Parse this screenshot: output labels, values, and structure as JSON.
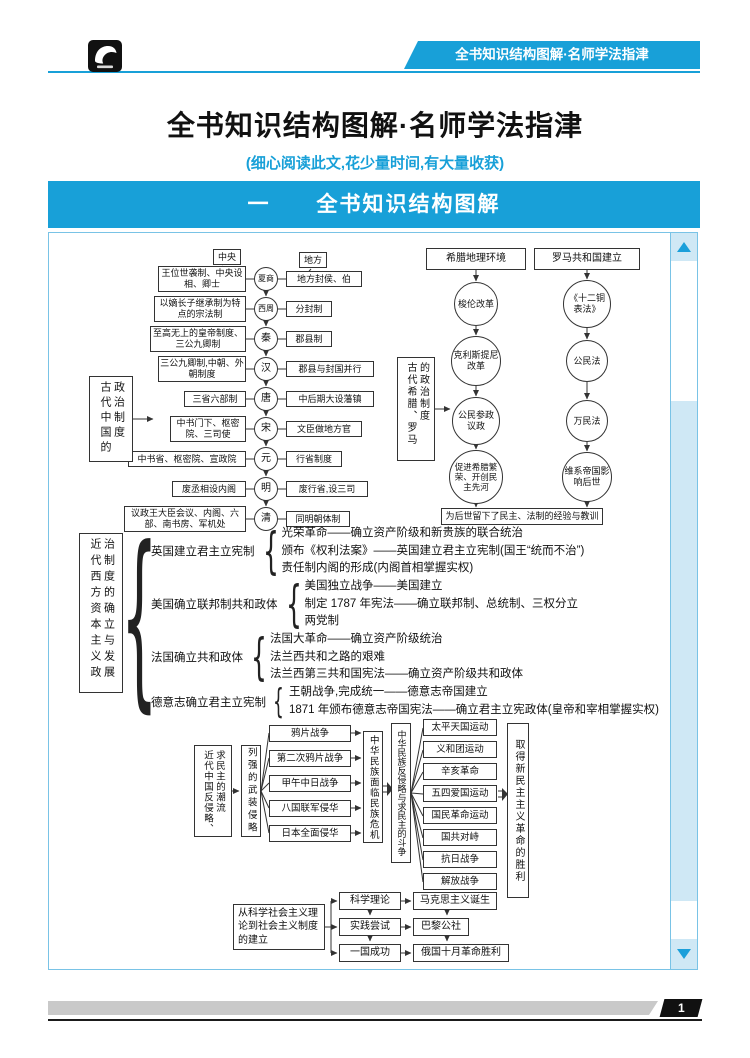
{
  "header": {
    "tab": "全书知识结构图解·名师学法指津"
  },
  "title": "全书知识结构图解·名师学法指津",
  "subtitle": "(细心阅读此文,花少量时间,有大量收获)",
  "banner": "一　　全书知识结构图解",
  "footer": {
    "page_number": "1"
  },
  "colors": {
    "accent": "#18a0d8",
    "light_blue": "#cfe8f5",
    "border_blue": "#79c3e6"
  },
  "ancient_china": {
    "label_col1": "古代中国的",
    "label_col2": "政治制度",
    "central": "中央",
    "local": "地方",
    "rows": [
      {
        "era": "夏商",
        "left": "王位世袭制、中央设相、卿士",
        "right": "地方封侯、伯"
      },
      {
        "era": "西周",
        "left": "以嫡长子继承制为特点的宗法制",
        "right": "分封制"
      },
      {
        "era": "秦",
        "left": "至高无上的皇帝制度、三公九卿制",
        "right": "郡县制"
      },
      {
        "era": "汉",
        "left": "三公九卿制,中朝、外朝制度",
        "right": "郡县与封国并行"
      },
      {
        "era": "唐",
        "left": "三省六部制",
        "right": "中后期大设藩镇"
      },
      {
        "era": "宋",
        "left": "中书门下、枢密院、三司使",
        "right": "文臣做地方官"
      },
      {
        "era": "元",
        "left": "中书省、枢密院、宣政院",
        "right": "行省制度"
      },
      {
        "era": "明",
        "left": "废丞相设内阁",
        "right": "废行省,设三司"
      },
      {
        "era": "清",
        "left": "议政王大臣会议、内阁、六部、南书房、军机处",
        "right": "同明朝体制"
      }
    ]
  },
  "greece_rome": {
    "label_col1": "古代希腊、罗马",
    "label_col2": "的政治制度",
    "greece_top": "希腊地理环境",
    "rome_top": "罗马共和国建立",
    "greece_nodes": [
      "梭伦改革",
      "克利斯提尼改革",
      "公民参政议政",
      "促进希腊繁荣、开创民主先河"
    ],
    "rome_nodes": [
      "《十二铜表法》",
      "公民法",
      "万民法",
      "维系帝国影响后世"
    ],
    "bottom": "为后世留下了民主、法制的经验与教训"
  },
  "modern_west": {
    "label_col1": "近代西方资本主义政",
    "label_col2": "治制度的确立与发展",
    "branches": [
      {
        "title": "英国建立君主立宪制",
        "items": [
          "光荣革命——确立资产阶级和新贵族的联合统治",
          "颁布《权利法案》——英国建立君主立宪制(国王“统而不治”)",
          "责任制内阁的形成(内阁首相掌握实权)"
        ]
      },
      {
        "title": "美国确立联邦制共和政体",
        "items": [
          "美国独立战争——美国建立",
          "制定 1787 年宪法——确立联邦制、总统制、三权分立",
          "两党制"
        ]
      },
      {
        "title": "法国确立共和政体",
        "items": [
          "法国大革命——确立资产阶级统治",
          "法兰西共和之路的艰难",
          "法兰西第三共和国宪法——确立资产阶级共和政体"
        ]
      },
      {
        "title": "德意志确立君主立宪制",
        "items": [
          "王朝战争,完成统一——德意志帝国建立",
          "1871 年颁布德意志帝国宪法——确立君主立宪政体(皇帝和宰相掌握实权)"
        ]
      }
    ]
  },
  "modern_china": {
    "label_col1": "近代中国反侵略、",
    "label_col2": "求民主的潮流",
    "invaders": "列强的武装侵略",
    "wars": [
      "鸦片战争",
      "第二次鸦片战争",
      "甲午中日战争",
      "八国联军侵华",
      "日本全面侵华"
    ],
    "crisis": "中华民族面临民族危机",
    "struggle": "中华民族反侵略与求民主的斗争",
    "movements": [
      "太平天国运动",
      "义和团运动",
      "辛亥革命",
      "五四爱国运动",
      "国民革命运动",
      "国共对峙",
      "抗日战争",
      "解放战争"
    ],
    "victory": "取得新民主主义革命的胜利"
  },
  "socialism": {
    "intro": "从科学社会主义理论到社会主义制度的建立",
    "pairs": [
      {
        "stage": "科学理论",
        "result": "马克思主义诞生"
      },
      {
        "stage": "实践尝试",
        "result": "巴黎公社"
      },
      {
        "stage": "一国成功",
        "result": "俄国十月革命胜利"
      }
    ]
  }
}
